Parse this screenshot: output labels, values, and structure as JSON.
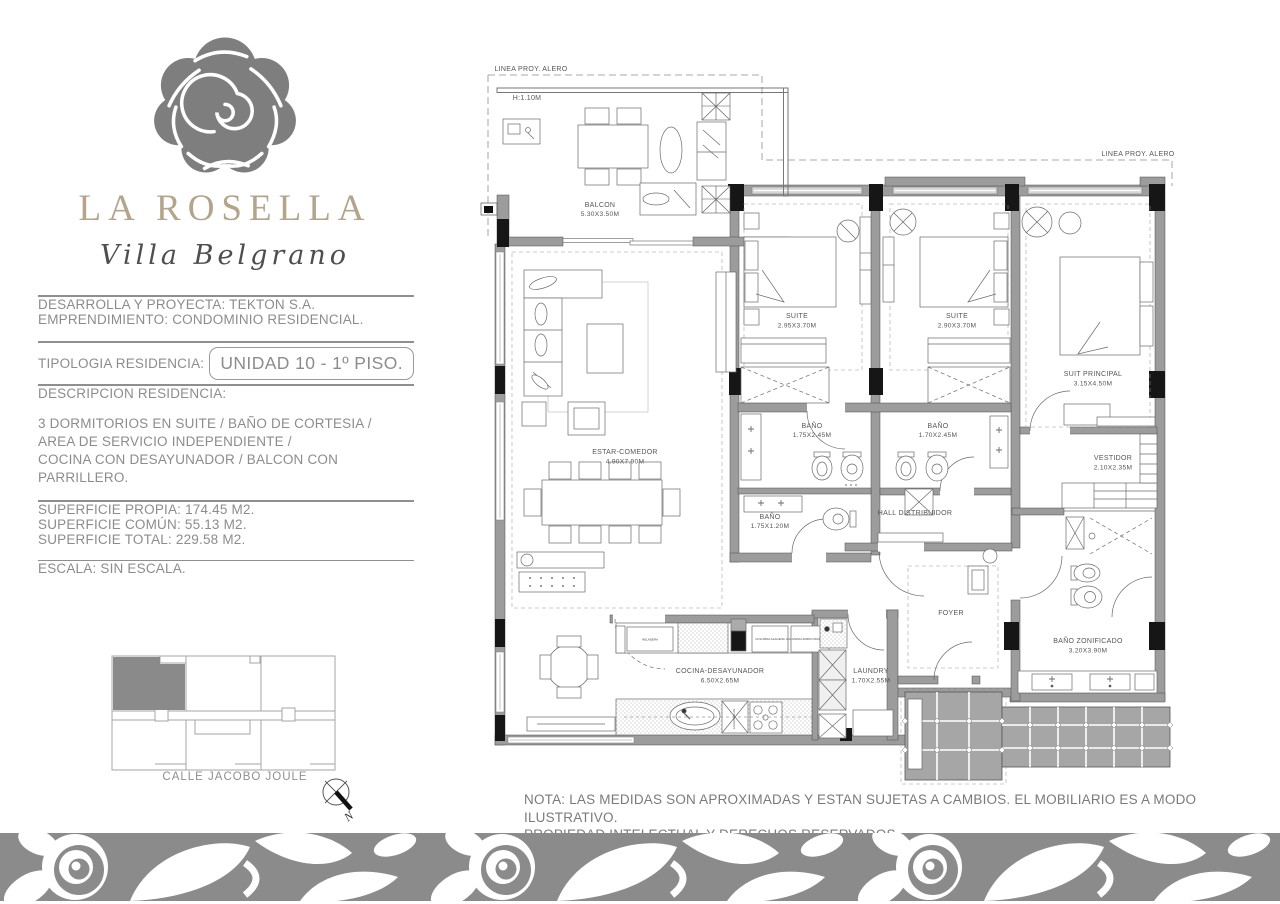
{
  "brand": {
    "name": "LA ROSELLA",
    "subtitle": "Villa Belgrano",
    "name_color": "#b3a48b",
    "rose_color": "#7d7d7d",
    "band_color": "#8b8b8b"
  },
  "info": {
    "developer": "DESARROLLA Y PROYECTA: TEKTON S.A.",
    "project": "EMPRENDIMIENTO: CONDOMINIO RESIDENCIAL.",
    "typology_label": "TIPOLOGIA RESIDENCIA:",
    "typology_value": "UNIDAD 10 - 1º PISO.",
    "description_label": "DESCRIPCION RESIDENCIA:",
    "description_line1": "3 DORMITORIOS EN SUITE / BAÑO DE CORTESIA /",
    "description_line2": "AREA DE SERVICIO INDEPENDIENTE /",
    "description_line3": "COCINA CON DESAYUNADOR / BALCON CON PARRILLERO.",
    "surface_own": "SUPERFICIE PROPIA: 174.45 M2.",
    "surface_common": "SUPERFICIE COMÚN:   55.13 M2.",
    "surface_total": "SUPERFICIE TOTAL:   229.58 M2.",
    "scale": "ESCALA: SIN ESCALA."
  },
  "key_plan": {
    "street": "CALLE JACOBO JOULE",
    "compass_label": "N"
  },
  "plan": {
    "alero_label": "LINEA PROY. ALERO",
    "height_label": "H:1.10M",
    "rooms": [
      {
        "name": "BALCON",
        "dims": "5.30X3.50M"
      },
      {
        "name": "ESTAR-COMEDOR",
        "dims": "4.90X7.90M"
      },
      {
        "name": "SUITE",
        "dims": "2.95X3.70M"
      },
      {
        "name": "SUITE",
        "dims": "2.90X3.70M"
      },
      {
        "name": "SUIT PRINCIPAL",
        "dims": "3.15X4.50M"
      },
      {
        "name": "BAÑO",
        "dims": "1.75X2.45M"
      },
      {
        "name": "BAÑO",
        "dims": "1.70X2.45M"
      },
      {
        "name": "BAÑO",
        "dims": "1.75X1.20M"
      },
      {
        "name": "HALL DISTRIBUIDOR",
        "dims": ""
      },
      {
        "name": "VESTIDOR",
        "dims": "2.10X2.35M"
      },
      {
        "name": "BAÑO ZONIFICADO",
        "dims": "3.20X3.90M"
      },
      {
        "name": "FOYER",
        "dims": ""
      },
      {
        "name": "COCINA-DESAYUNADOR",
        "dims": "6.50X2.65M"
      },
      {
        "name": "LAUNDRY",
        "dims": "1.70X2.55M"
      }
    ],
    "kitchen_units": [
      "HELADERA",
      "COLUMNA ALACENA",
      "COLUMNA HORNO MICROONDAS",
      "LAVAVAJILLAS"
    ]
  },
  "note": {
    "line1": "NOTA: LAS MEDIDAS SON APROXIMADAS Y ESTAN SUJETAS A CAMBIOS. EL MOBILIARIO ES A MODO ILUSTRATIVO.",
    "line2": "PROPIEDAD INTELECTUAL Y DERECHOS RESERVADOS."
  }
}
